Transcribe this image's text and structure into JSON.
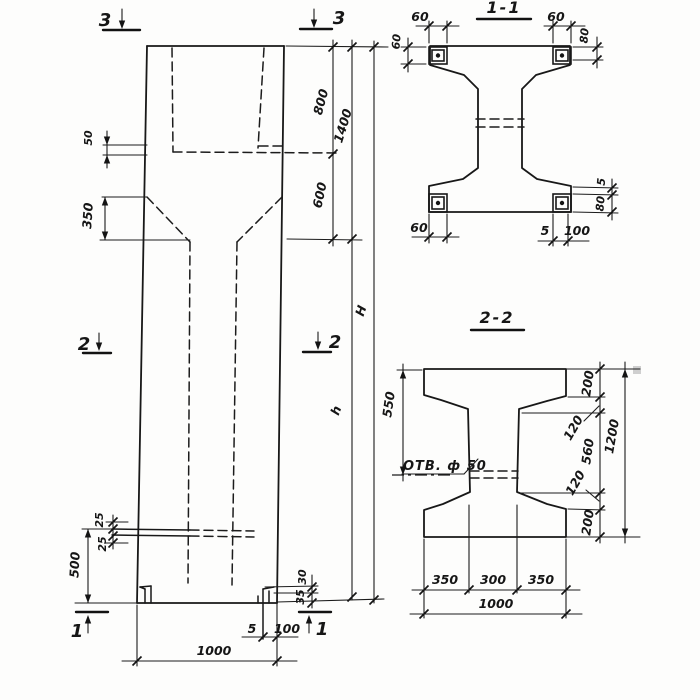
{
  "drawing": {
    "elevation": {
      "markers": {
        "m3_left": "3",
        "m3_right": "3",
        "m2_left": "2",
        "m2_right": "2",
        "m1_left": "1",
        "m1_right": "1"
      },
      "dims": {
        "d50": "50",
        "d350": "350",
        "d800": "800",
        "d1400": "1400",
        "d600": "600",
        "dH": "H",
        "dh": "h",
        "d25_upper": "25",
        "d25_lower": "25",
        "d500": "500",
        "d30": "30",
        "d35": "35",
        "d5": "5",
        "d100": "100",
        "d1000": "1000"
      }
    },
    "section11": {
      "title": "1-1",
      "dims": {
        "top_left_w": "60",
        "top_left_h": "60",
        "top_right_w": "60",
        "top_right_h": "80",
        "bottom_left_w": "60",
        "bottom_gap": "5",
        "bottom_w": "100",
        "right_gap": "5",
        "right_h": "80"
      }
    },
    "section22": {
      "title": "2-2",
      "hole_label": "ОТВ. ф 50",
      "dims": {
        "d550": "550",
        "top200": "200",
        "top120": "120",
        "web560": "560",
        "bot120": "120",
        "bot200": "200",
        "d1200": "1200",
        "b350l": "350",
        "b300": "300",
        "b350r": "350",
        "b1000": "1000"
      }
    }
  }
}
